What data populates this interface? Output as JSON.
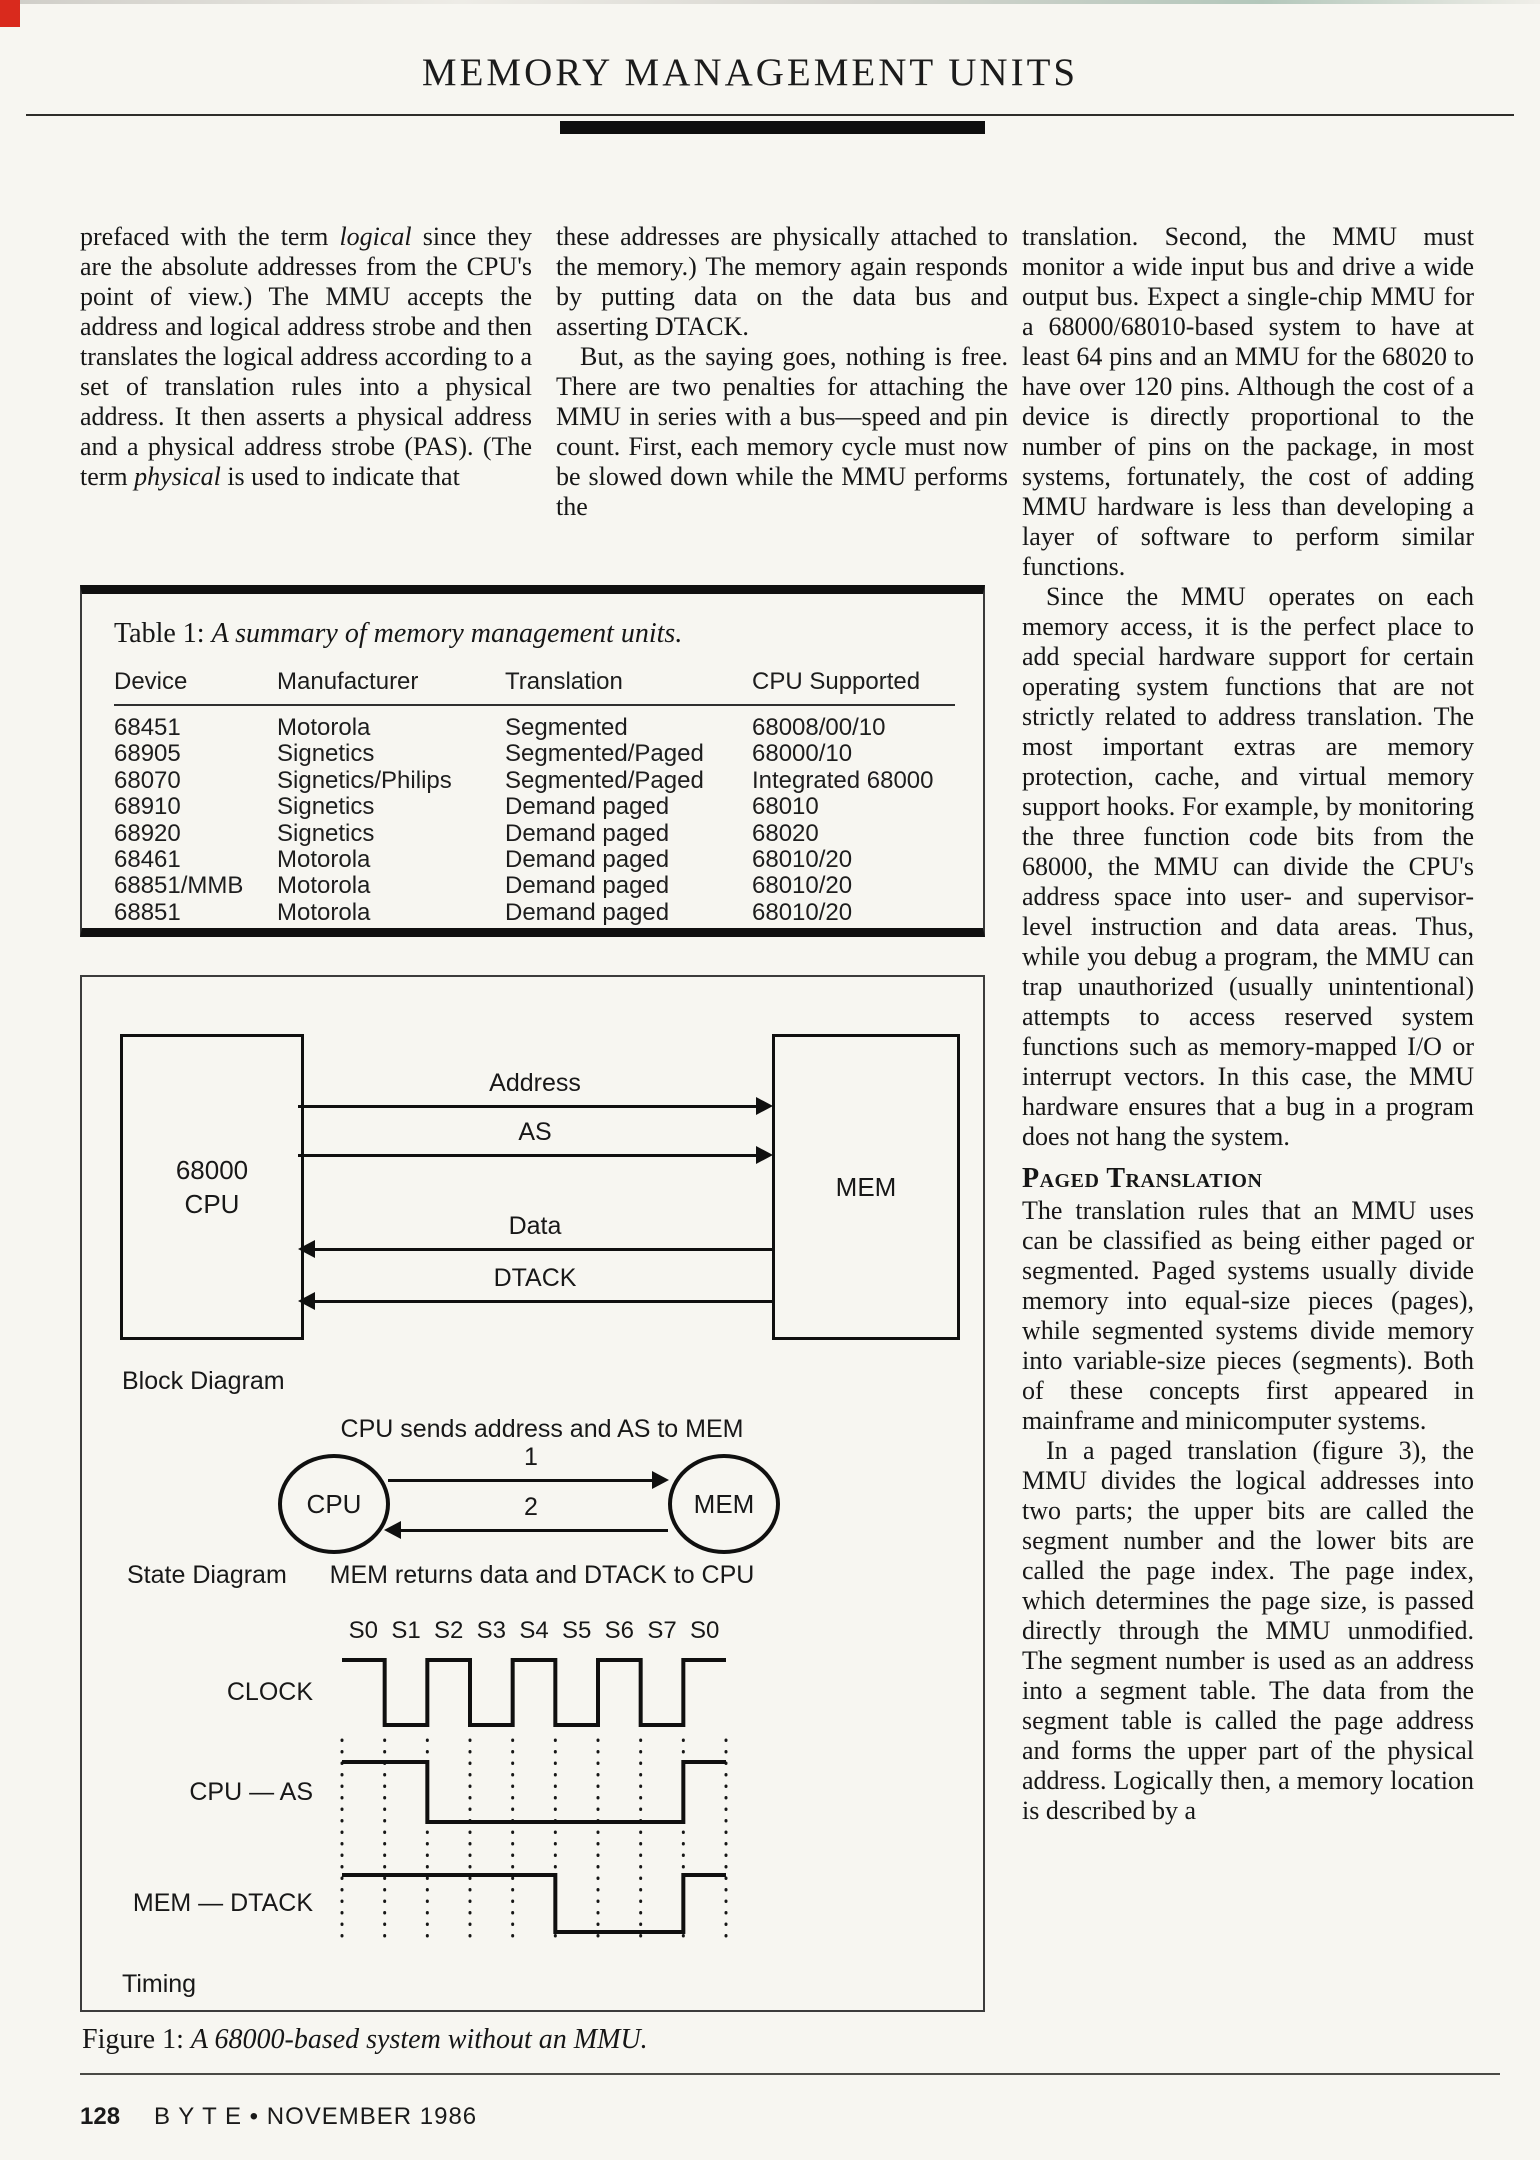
{
  "header": {
    "title": "MEMORY MANAGEMENT UNITS"
  },
  "article": {
    "col1": {
      "p1_parts": [
        {
          "t": "prefaced with the term ",
          "i": false
        },
        {
          "t": "logical",
          "i": true
        },
        {
          "t": " since they are the absolute addresses from the CPU's point of view.) The MMU accepts the address and logical address strobe and then translates the logical address according to a set of translation rules into a physical address. It then asserts a physical address and a physical address strobe (PAS). (The term ",
          "i": false
        },
        {
          "t": "physical",
          "i": true
        },
        {
          "t": " is used to indicate that",
          "i": false
        }
      ]
    },
    "col2": {
      "p1": "these addresses are physically attached to the memory.) The memory again responds by putting data on the data bus and asserting DTACK.",
      "p2": "But, as the saying goes, nothing is free. There are two penalties for attaching the MMU in series with a bus—speed and pin count. First, each memory cycle must now be slowed down while the MMU performs the"
    },
    "col3": {
      "p1": "translation. Second, the MMU must monitor a wide input bus and drive a wide output bus. Expect a single-chip MMU for a 68000/68010-based system to have at least 64 pins and an MMU for the 68020 to have over 120 pins. Although the cost of a device is directly proportional to the number of pins on the package, in most systems, fortunately, the cost of adding MMU hardware is less than developing a layer of software to perform similar functions.",
      "p2": "Since the MMU operates on each memory access, it is the perfect place to add special hardware support for certain operating system functions that are not strictly related to address translation. The most important extras are memory protection, cache, and virtual memory support hooks. For example, by monitoring the three function code bits from the 68000, the MMU can divide the CPU's address space into user- and supervisor-level instruction and data areas. Thus, while you debug a program, the MMU can trap unauthorized (usually unintentional) attempts to access reserved system functions such as memory-mapped I/O or interrupt vectors. In this case, the MMU hardware ensures that a bug in a program does not hang the system.",
      "heading": "Paged Translation",
      "p3": "The translation rules that an MMU uses can be classified as being either paged or segmented. Paged systems usually divide memory into equal-size pieces (pages), while segmented systems divide memory into variable-size pieces (segments). Both of these concepts first appeared in mainframe and minicomputer systems.",
      "p4": "In a paged translation (figure 3), the MMU divides the logical addresses into two parts; the upper bits are called the segment number and the lower bits are called the page index. The page index, which determines the page size, is passed directly through the MMU unmodified. The segment number is used as an address into a segment table. The data from the segment table is called the page address and forms the upper part of the physical address. Logically then, a memory location is described by a"
    }
  },
  "table1": {
    "title_prefix": "Table 1: ",
    "title_italic": "A summary of memory management units.",
    "headers": [
      "Device",
      "Manufacturer",
      "Translation",
      "CPU Supported"
    ],
    "rows": [
      [
        "68451",
        "Motorola",
        "Segmented",
        "68008/00/10"
      ],
      [
        "68905",
        "Signetics",
        "Segmented/Paged",
        "68000/10"
      ],
      [
        "68070",
        "Signetics/Philips",
        "Segmented/Paged",
        "Integrated 68000"
      ],
      [
        "68910",
        "Signetics",
        "Demand paged",
        "68010"
      ],
      [
        "68920",
        "Signetics",
        "Demand paged",
        "68020"
      ],
      [
        "68461",
        "Motorola",
        "Demand paged",
        "68010/20"
      ],
      [
        "68851/MMB",
        "Motorola",
        "Demand paged",
        "68010/20"
      ],
      [
        "68851",
        "Motorola",
        "Demand paged",
        "68010/20"
      ]
    ]
  },
  "figure1": {
    "block": {
      "cpu_line1": "68000",
      "cpu_line2": "CPU",
      "mem": "MEM",
      "signals": [
        {
          "label": "Address",
          "dir": "right"
        },
        {
          "label": "AS",
          "dir": "right"
        },
        {
          "label": "Data",
          "dir": "left"
        },
        {
          "label": "DTACK",
          "dir": "left"
        }
      ],
      "label": "Block Diagram"
    },
    "state": {
      "top_caption": "CPU sends address and AS to MEM",
      "arrow1": "1",
      "arrow2": "2",
      "cpu": "CPU",
      "mem": "MEM",
      "label": "State Diagram",
      "bottom_caption": "MEM returns data and DTACK to CPU"
    },
    "timing": {
      "states": [
        "S0",
        "S1",
        "S2",
        "S3",
        "S4",
        "S5",
        "S6",
        "S7",
        "S0"
      ],
      "signals": [
        {
          "label": "CLOCK",
          "levels": [
            1,
            0,
            1,
            0,
            1,
            0,
            1,
            0,
            1
          ]
        },
        {
          "label": "CPU — AS",
          "levels": [
            1,
            1,
            0,
            0,
            0,
            0,
            0,
            0,
            1
          ]
        },
        {
          "label": "MEM — DTACK",
          "levels": [
            1,
            1,
            1,
            1,
            1,
            0,
            0,
            0,
            1
          ]
        }
      ],
      "label": "Timing"
    },
    "caption_prefix": "Figure 1: ",
    "caption_italic": "A 68000-based system without an MMU."
  },
  "footer": {
    "page_number": "128",
    "text": "B Y T E • NOVEMBER 1986"
  }
}
